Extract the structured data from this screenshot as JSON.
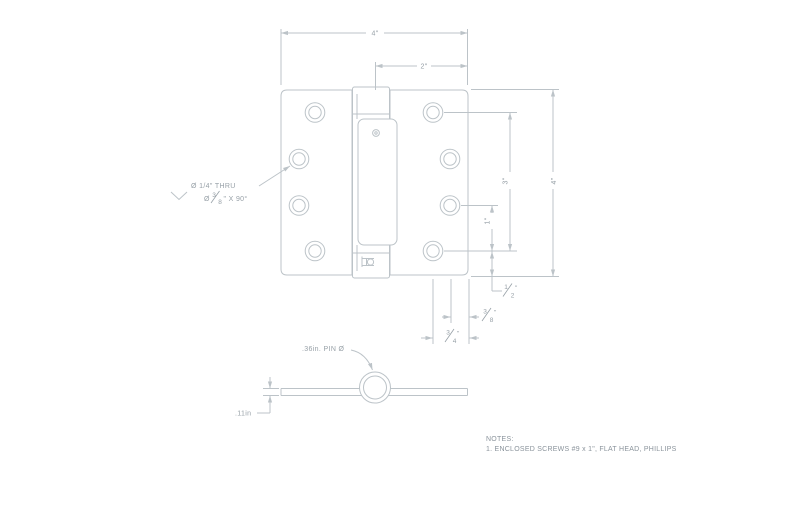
{
  "colors": {
    "line": "#bcc3c8",
    "text": "#97a0a7",
    "notes_text": "#8a939b",
    "background": "#ffffff"
  },
  "dims": {
    "width": "4\"",
    "half_width": "2\"",
    "height": "4\"",
    "hole_span": "3\"",
    "hole_pitch": "1\"",
    "half": {
      "num": "1",
      "den": "2",
      "unit": "\""
    },
    "three_eighths": {
      "num": "3",
      "den": "8",
      "unit": "\""
    },
    "three_quarters": {
      "num": "3",
      "den": "4",
      "unit": "\""
    }
  },
  "hole_callout": {
    "line1": "Ø 1/4\" THRU",
    "dia": "Ø",
    "num": "3",
    "den": "8",
    "suffix": "\" X 90°"
  },
  "section": {
    "pin": ".36in. PIN Ø",
    "thickness": ".11in"
  },
  "notes": {
    "title": "NOTES:",
    "item": "1.  ENCLOSED SCREWS #9 x 1\", FLAT HEAD, PHILLIPS"
  }
}
